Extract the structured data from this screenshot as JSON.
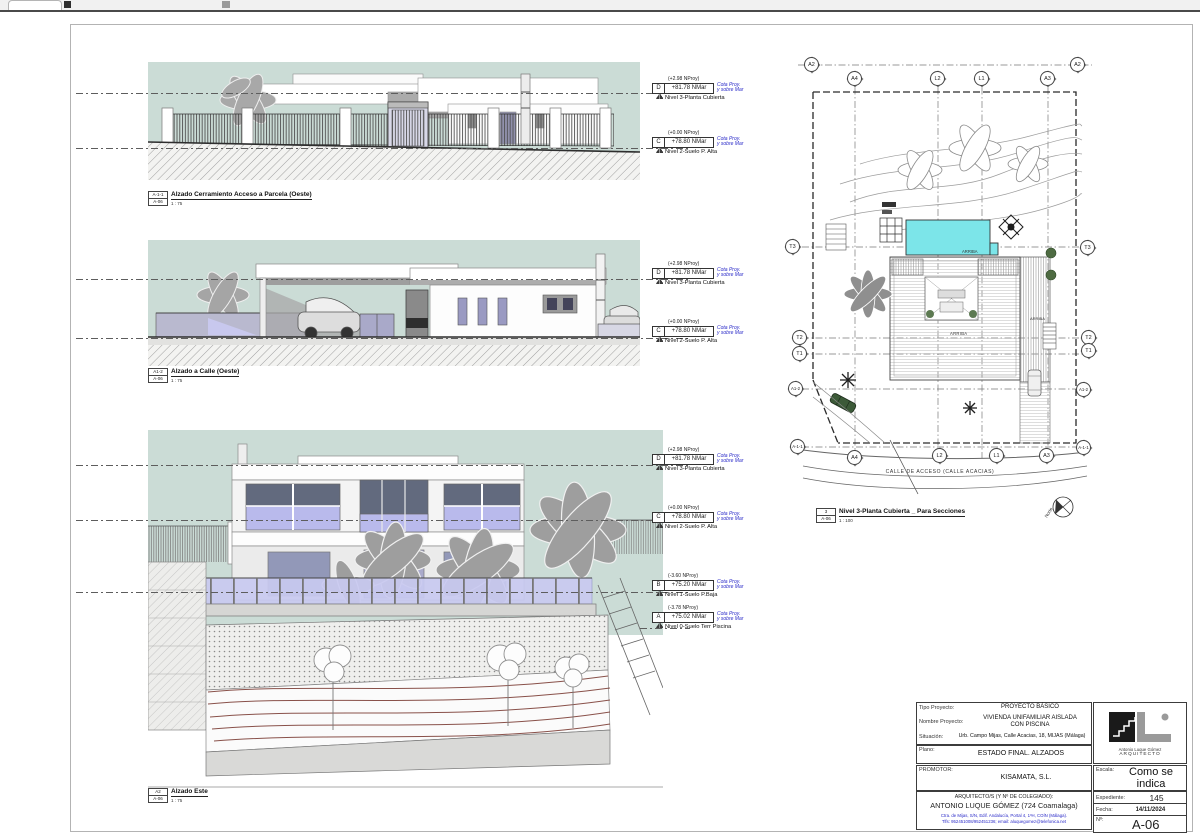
{
  "colors": {
    "sky": "#cbdcd6",
    "pool": "#7ce5e9",
    "annotation_blue": "#2a2ac8",
    "contour_maroon": "#7d3f37",
    "glass_lavender": "#b9baec"
  },
  "elevations": [
    {
      "ref": "A-1-1",
      "sheet_ref": "A-06",
      "title": "Alzado Cerramiento Acceso a Parcela (Oeste)",
      "scale": "1 : 75"
    },
    {
      "ref": "A1-2",
      "sheet_ref": "A-06",
      "title": "Alzado a Calle (Oeste)",
      "scale": "1 : 75"
    },
    {
      "ref": "A2",
      "sheet_ref": "A-06",
      "title": "Alzado Este",
      "scale": "1 : 75"
    }
  ],
  "site_plan": {
    "ref": "3",
    "sheet_ref": "A-06",
    "title": "Nivel 3-Planta Cubierta _ Para Secciones",
    "scale": "1 : 100",
    "street_label": "CALLE DE ACCESO (CALLE ACACIAS)",
    "arriba_pool": "ARRIBA",
    "arriba_center": "ARRIBA",
    "arriba_right": "ARRIBA",
    "north_label": "Norte",
    "grid_top": [
      "A2",
      "A4",
      "L2",
      "L1",
      "A3",
      "A2"
    ],
    "grid_bottom": [
      "A4",
      "L2",
      "L1",
      "A3"
    ],
    "grid_left": [
      "T3",
      "T2",
      "T1",
      "A1-2",
      "A-1-1"
    ],
    "grid_right": [
      "T3",
      "T2",
      "T1",
      "A1-2",
      "A-1-1"
    ]
  },
  "levels": {
    "cota_line1": "Cota Proy.",
    "cota_line2": "y sobre Mar",
    "items": [
      {
        "letter": "D",
        "proy": "(+2.98 NProy)",
        "value": "+81.78 NMar",
        "name": "Nivel 3-Planta Cubierta"
      },
      {
        "letter": "C",
        "proy": "(+0.00 NProy)",
        "value": "+78.80 NMar",
        "name": "Nivel 2-Suelo P. Alta"
      },
      {
        "letter": "B",
        "proy": "(-3.60 NProy)",
        "value": "+75.20 NMar",
        "name": "Nivel 1-Suelo P.Baja"
      },
      {
        "letter": "A",
        "proy": "(-3.78 NProy)",
        "value": "+75.02 NMar",
        "name": "Nivel 0-Suelo Terr Piscina"
      }
    ]
  },
  "title_block": {
    "tipo_label": "Tipo Proyecto:",
    "tipo_value": "PROYECTO BÁSICO",
    "nombre_label": "Nombre Proyecto:",
    "nombre_value": "VIVIENDA UNIFAMILIAR AISLADA CON PISCINA",
    "situacion_label": "Situación:",
    "situacion_value": "Urb. Campo Mijas, Calle Acacias, 18, MIJAS (Málaga)",
    "plano_label": "Plano:",
    "plano_value": "ESTADO FINAL. ALZADOS",
    "promotor_label": "PROMOTOR:",
    "promotor_value": "KISAMATA, S.L.",
    "arquitecto_label": "ARQUITECTO/S (Y Nº DE COLEGIADO):",
    "arquitecto_value": "ANTONIO LUQUE GÓMEZ (724 Coamalaga)",
    "contact_line1": "Ctra. de Mijas, S/N, Edif. Andalucía, Portal 4, 1ºH, COÍN (Málaga).",
    "contact_line2": "Tlfs: 952451008/952451236; email: aluquegomez@telefonica.net",
    "logo_name": "Antonio Luque Gómez",
    "logo_role": "ARQUITECTO",
    "escala_label": "Escala:",
    "escala_value": "Como se indica",
    "expediente_label": "Expediente:",
    "expediente_value": "145",
    "fecha_label": "Fecha:",
    "fecha_value": "14/11/2024",
    "num_label": "Nº:",
    "num_value": "A-06"
  }
}
